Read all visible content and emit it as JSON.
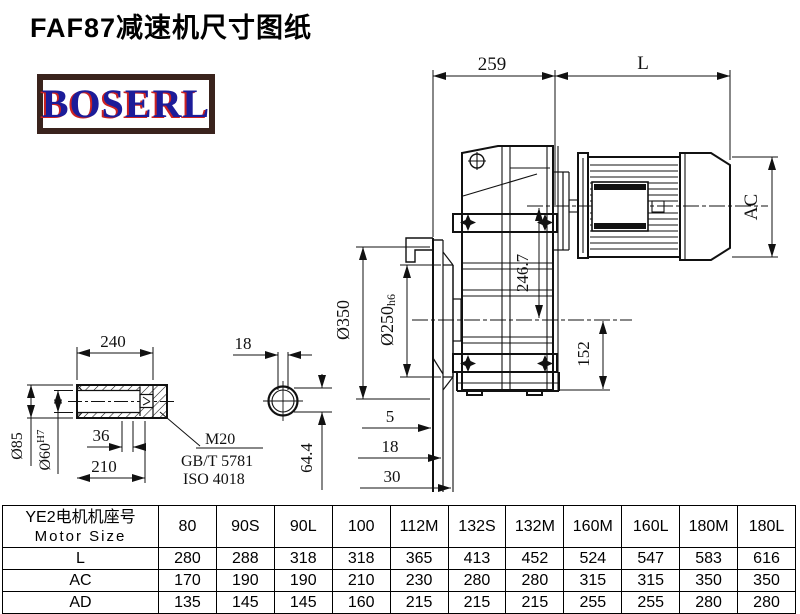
{
  "title": "FAF87减速机尺寸图纸",
  "logo": {
    "text": "BOSERL"
  },
  "drawing": {
    "dims": {
      "housing_width": "259",
      "motor_length": "L",
      "motor_diameter": "AC",
      "axis_distance": "246.7",
      "flange_od": "Ø350",
      "pilot_prefix": "Ø250",
      "pilot_tol": "h6",
      "lower_height": "152",
      "flange_offset_1": "5",
      "flange_offset_2": "18",
      "flange_offset_3": "30",
      "shaft_length": "240",
      "shaft_od": "Ø85",
      "bore_prefix": "Ø60",
      "bore_tol": "H7",
      "bore_step": "36",
      "hub_length": "210",
      "key_width": "18",
      "key_height": "64.4",
      "thread": "M20",
      "thread_std_1": "GB/T 5781",
      "thread_std_2": "ISO 4018"
    }
  },
  "table": {
    "header": {
      "line1": "YE2电机机座号",
      "line2": "Motor Size"
    },
    "columns": [
      "80",
      "90S",
      "90L",
      "100",
      "112M",
      "132S",
      "132M",
      "160M",
      "160L",
      "180M",
      "180L"
    ],
    "rows": [
      {
        "label": "L",
        "values": [
          "280",
          "288",
          "318",
          "318",
          "365",
          "413",
          "452",
          "524",
          "547",
          "583",
          "616"
        ]
      },
      {
        "label": "AC",
        "values": [
          "170",
          "190",
          "190",
          "210",
          "230",
          "280",
          "280",
          "315",
          "315",
          "350",
          "350"
        ]
      },
      {
        "label": "AD",
        "values": [
          "135",
          "145",
          "145",
          "160",
          "215",
          "215",
          "215",
          "255",
          "255",
          "280",
          "280"
        ]
      }
    ]
  },
  "colors": {
    "line": "#111111",
    "logo_border": "#3a231d",
    "logo_text": "#1c1c99",
    "logo_shadow": "#cc2222"
  }
}
